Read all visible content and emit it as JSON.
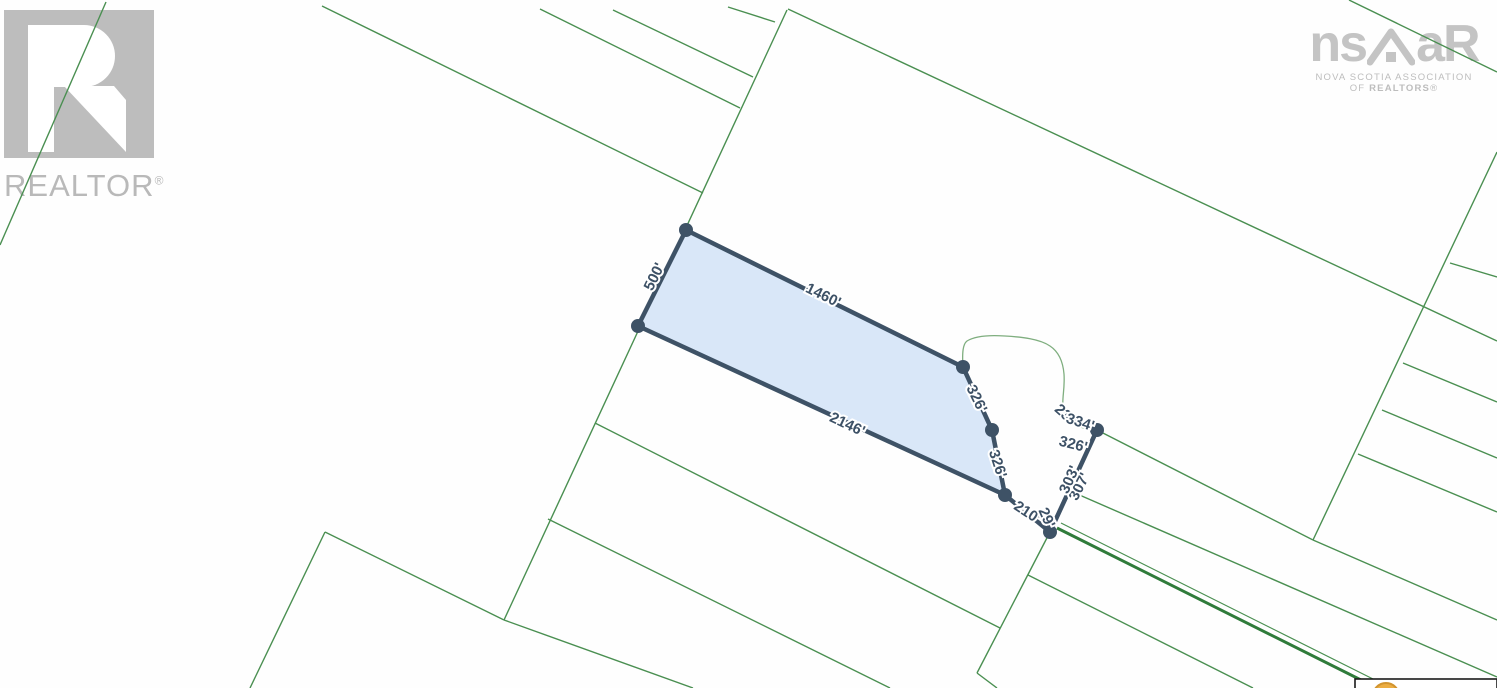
{
  "branding": {
    "realtor": {
      "word": "REALTOR",
      "reg": "®"
    },
    "nsar": {
      "ns": "ns",
      "ar": "aR",
      "line1": "NOVA SCOTIA ASSOCIATION",
      "line2_prefix": "OF ",
      "line2_bold": "REALTORS",
      "line2_reg": "®"
    }
  },
  "map": {
    "colors": {
      "line_green": "#4a8f51",
      "line_green_dark": "#2f7b3a",
      "stream_green": "#7fae7f",
      "lot_stroke": "#3e5266",
      "lot_fill": "#d9e7f8",
      "label_color": "#3d5166",
      "label_halo": "#ffffff",
      "marker_fill": "#ecad42",
      "marker_ring": "#d1942f",
      "box_border": "#1a1a1a",
      "logo_gray": "#bdbdbd"
    },
    "highlighted_lot": {
      "polygon": [
        [
          686,
          230
        ],
        [
          963,
          367
        ],
        [
          992,
          430
        ],
        [
          1005,
          495
        ],
        [
          638,
          326
        ]
      ],
      "tail": [
        [
          1005,
          495
        ],
        [
          1050,
          532
        ],
        [
          1097,
          430
        ]
      ],
      "vertices": [
        [
          686,
          230
        ],
        [
          638,
          326
        ],
        [
          963,
          367
        ],
        [
          992,
          430
        ],
        [
          1005,
          495
        ],
        [
          1050,
          532
        ],
        [
          1097,
          430
        ]
      ],
      "vertex_radius": 7,
      "stroke_width": 4.5
    },
    "stream_path": "M 963 368 C 962 352 963 344 967 341 C 975 336 990 335 1005 336 C 1022 337 1040 339 1050 346 C 1059 352 1063 362 1064 374 C 1065 388 1062 398 1063 406 C 1064 416 1070 424 1080 427 L 1092 430",
    "parcel_lines": [
      {
        "p": [
          106,
          2,
          0,
          245
        ]
      },
      {
        "p": [
          322,
          6,
          703,
          193
        ]
      },
      {
        "p": [
          787,
          10,
          504,
          620
        ]
      },
      {
        "p": [
          540,
          9,
          740,
          108
        ]
      },
      {
        "p": [
          613,
          10,
          753,
          77
        ]
      },
      {
        "p": [
          728,
          7,
          775,
          22
        ]
      },
      {
        "p": [
          788,
          9,
          1497,
          341
        ]
      },
      {
        "p": [
          1349,
          0,
          1497,
          72
        ]
      },
      {
        "p": [
          595,
          423,
          1000,
          628
        ]
      },
      {
        "p": [
          548,
          519,
          890,
          688
        ]
      },
      {
        "p": [
          325,
          532,
          250,
          688
        ]
      },
      {
        "p": [
          325,
          532,
          504,
          620
        ]
      },
      {
        "p": [
          504,
          620,
          693,
          688
        ]
      },
      {
        "p": [
          1050,
          532,
          977,
          673
        ]
      },
      {
        "p": [
          977,
          673,
          997,
          688
        ]
      },
      {
        "p": [
          1028,
          575,
          1253,
          688
        ]
      },
      {
        "p": [
          1068,
          490,
          1497,
          677
        ]
      },
      {
        "p": [
          1097,
          430,
          1313,
          540
        ]
      },
      {
        "p": [
          1313,
          540,
          1497,
          620
        ]
      },
      {
        "p": [
          1497,
          152,
          1313,
          540
        ]
      },
      {
        "p": [
          1450,
          263,
          1497,
          277
        ]
      },
      {
        "p": [
          1403,
          363,
          1497,
          402
        ]
      },
      {
        "p": [
          1382,
          410,
          1497,
          458
        ]
      },
      {
        "p": [
          1358,
          454,
          1497,
          512
        ]
      },
      {
        "p": [
          1057,
          528,
          1377,
          688
        ],
        "w": 3,
        "dark": true
      },
      {
        "p": [
          1061,
          523,
          1381,
          683
        ],
        "w": 1.2
      }
    ],
    "labels": [
      {
        "t": "500'",
        "x": 655,
        "y": 277,
        "r": -64
      },
      {
        "t": "1460'",
        "x": 823,
        "y": 296,
        "r": 26
      },
      {
        "t": "2146'",
        "x": 847,
        "y": 425,
        "r": 25
      },
      {
        "t": "326'",
        "x": 976,
        "y": 399,
        "r": 64
      },
      {
        "t": "326'",
        "x": 997,
        "y": 464,
        "r": 72
      },
      {
        "t": "210'",
        "x": 1027,
        "y": 513,
        "r": 33
      },
      {
        "t": "29'",
        "x": 1046,
        "y": 518,
        "r": 66
      },
      {
        "t": "307'",
        "x": 1080,
        "y": 487,
        "r": -63
      },
      {
        "t": "303'",
        "x": 1070,
        "y": 480,
        "r": -66
      },
      {
        "t": "233'",
        "x": 1067,
        "y": 417,
        "r": 42
      },
      {
        "t": "334'",
        "x": 1080,
        "y": 423,
        "r": 18
      },
      {
        "t": "326'",
        "x": 1073,
        "y": 445,
        "r": 14
      }
    ],
    "label_font_size": 15,
    "marker_box": {
      "x": 1355,
      "y": 679,
      "w": 142,
      "h": 10,
      "circle_cx": 1386,
      "circle_cy": 696,
      "circle_r": 13
    }
  }
}
